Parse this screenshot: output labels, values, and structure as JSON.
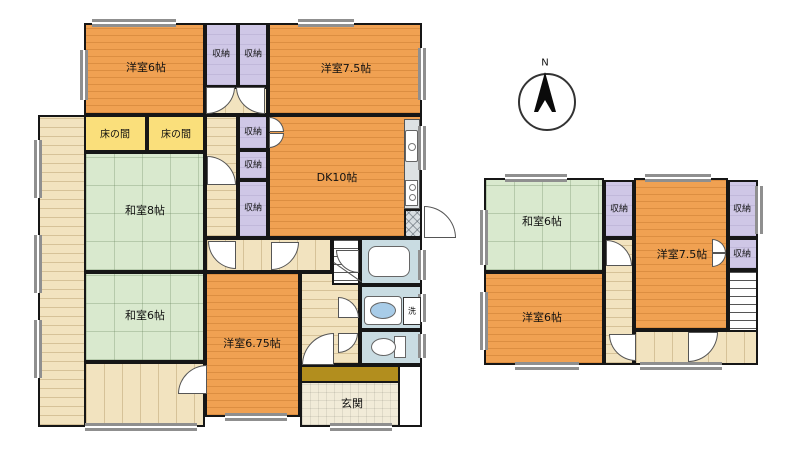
{
  "compass": {
    "north": "N"
  },
  "labels": {
    "closet": "収納",
    "alcove": "床の間",
    "laundry": "洗"
  },
  "floor1": {
    "western6": "洋室6帖",
    "western75": "洋室7.5帖",
    "dk10": "DK10帖",
    "japanese8": "和室8帖",
    "japanese6": "和室6帖",
    "western675": "洋室6.75帖",
    "entrance": "玄関"
  },
  "floor2": {
    "japanese6": "和室6帖",
    "western75": "洋室7.5帖",
    "western6": "洋室6帖"
  },
  "colors": {
    "flooring": "#F0A152",
    "tatami": "#D9E9CE",
    "alcove": "#FADF7B",
    "closet": "#CFC7E6",
    "corridor": "#F2E3BF",
    "wet": "#C9DCE2",
    "entrance_tile": "#F1EBD8",
    "entrance_step": "#B28E1E",
    "wall": "#161616",
    "window_gray": "#8F8F8F"
  }
}
